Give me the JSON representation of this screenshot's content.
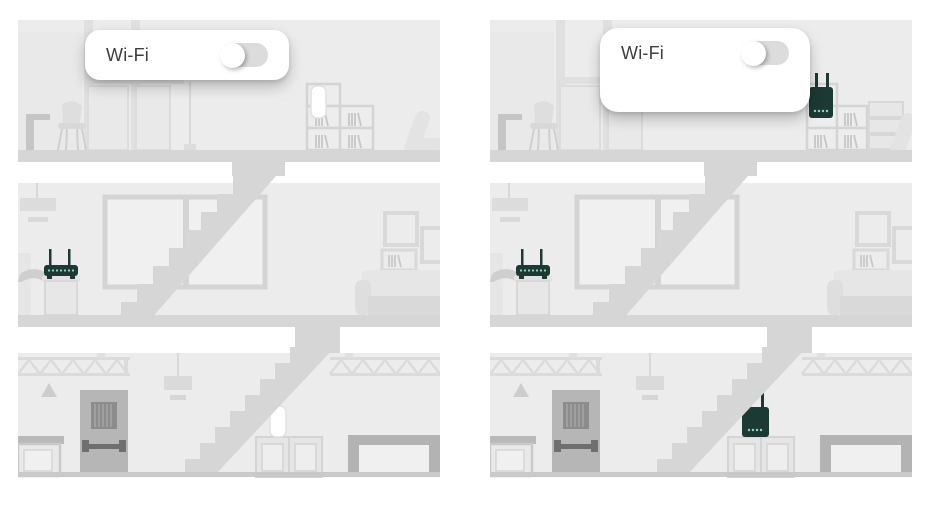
{
  "panels": [
    {
      "card": {
        "label": "Wi-Fi",
        "toggle_state": "off"
      },
      "devices": {
        "router": {
          "type": "wifi-router",
          "floor": "middle"
        },
        "extender_top": {
          "type": "wifi-extender",
          "floor": "top",
          "state": "inactive-white"
        },
        "extender_bottom": {
          "type": "wifi-extender",
          "floor": "bottom",
          "state": "inactive-white"
        }
      }
    },
    {
      "card": {
        "label": "Wi-Fi",
        "toggle_state": "off"
      },
      "devices": {
        "router": {
          "type": "wifi-router",
          "floor": "middle"
        },
        "extender_top": {
          "type": "wifi-extender",
          "floor": "top",
          "state": "active-dark"
        },
        "extender_bottom": {
          "type": "wifi-extender",
          "floor": "bottom",
          "state": "active-dark"
        }
      }
    }
  ],
  "colors": {
    "device": "#1d3934",
    "led": "#93d6c4",
    "wall": "#ececec",
    "structure": "#d6d6d6",
    "card_background": "#ffffff",
    "label_text": "#3d3d3d",
    "toggle_track": "#dcdcdc"
  }
}
